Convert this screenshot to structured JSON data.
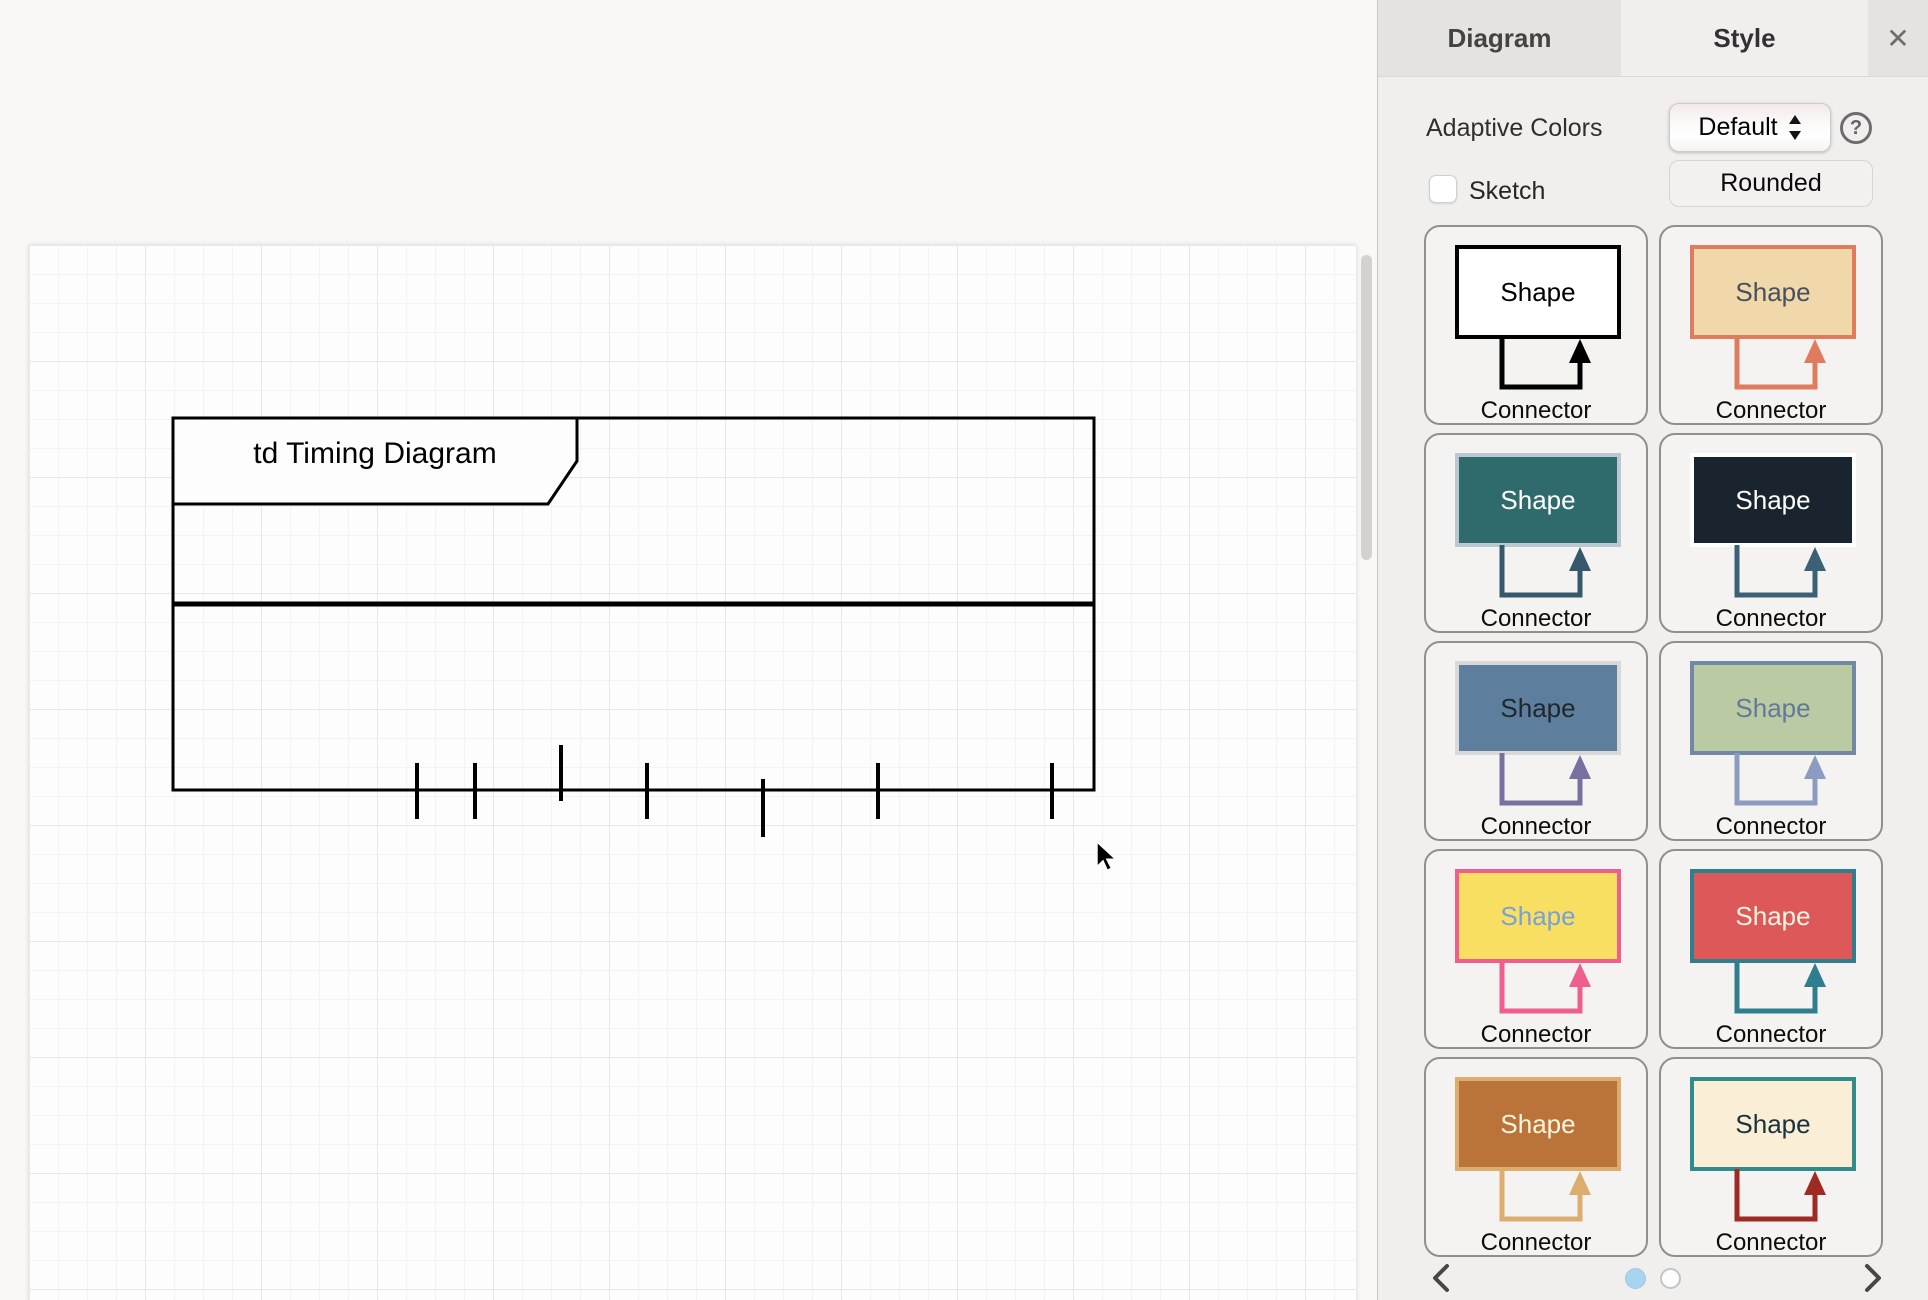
{
  "canvas": {
    "diagram": {
      "frame_title": "td Timing Diagram",
      "frame": {
        "x": 173,
        "y": 418,
        "width": 921,
        "height": 372,
        "stroke": "#000000",
        "stroke_width": 3
      },
      "title_box": {
        "points": "173,418 577,418 577,461 548,504 173,504",
        "fill": "#fdfdfd"
      },
      "title_pos": {
        "x": 375,
        "y": 463
      },
      "divider": {
        "y": 604,
        "stroke_width": 5
      },
      "ticks": [
        {
          "x": 417,
          "y1": 763,
          "y2": 819
        },
        {
          "x": 475,
          "y1": 763,
          "y2": 819
        },
        {
          "x": 561,
          "y1": 745,
          "y2": 801
        },
        {
          "x": 647,
          "y1": 763,
          "y2": 819
        },
        {
          "x": 763,
          "y1": 779,
          "y2": 837
        },
        {
          "x": 878,
          "y1": 763,
          "y2": 819
        },
        {
          "x": 1052,
          "y1": 763,
          "y2": 819
        }
      ]
    }
  },
  "panel": {
    "tabs": [
      {
        "id": "diagram",
        "label": "Diagram",
        "active": false
      },
      {
        "id": "style",
        "label": "Style",
        "active": true
      }
    ],
    "close_icon": "✕",
    "adaptive_colors": {
      "label": "Adaptive Colors",
      "value": "Default",
      "help_icon": "?"
    },
    "sketch": {
      "label": "Sketch",
      "checked": false
    },
    "rounded_label": "Rounded",
    "style_presets": [
      {
        "shape_label": "Shape",
        "connector_label": "Connector",
        "fill": "#ffffff",
        "stroke": "#000000",
        "text": "#000000",
        "connector": "#000000"
      },
      {
        "shape_label": "Shape",
        "connector_label": "Connector",
        "fill": "#f0d8aa",
        "stroke": "#e07c5e",
        "text": "#46505f",
        "connector": "#e07c5e"
      },
      {
        "shape_label": "Shape",
        "connector_label": "Connector",
        "fill": "#2f6a6d",
        "stroke": "#bac9d1",
        "text": "#ffffff",
        "connector": "#36586d"
      },
      {
        "shape_label": "Shape",
        "connector_label": "Connector",
        "fill": "#19242f",
        "stroke": "#ffffff",
        "text": "#ffffff",
        "connector": "#3c6076"
      },
      {
        "shape_label": "Shape",
        "connector_label": "Connector",
        "fill": "#5d7f9d",
        "stroke": "#d9d9d9",
        "text": "#20272e",
        "connector": "#78719f"
      },
      {
        "shape_label": "Shape",
        "connector_label": "Connector",
        "fill": "#bacba4",
        "stroke": "#7289a6",
        "text": "#64789a",
        "connector": "#8c9cc1"
      },
      {
        "shape_label": "Shape",
        "connector_label": "Connector",
        "fill": "#f8df62",
        "stroke": "#ee5f90",
        "text": "#76a2d9",
        "connector": "#ee5f90"
      },
      {
        "shape_label": "Shape",
        "connector_label": "Connector",
        "fill": "#dd5858",
        "stroke": "#307d8e",
        "text": "#fdf5e2",
        "connector": "#307d8e"
      },
      {
        "shape_label": "Shape",
        "connector_label": "Connector",
        "fill": "#ba7439",
        "stroke": "#dcad6e",
        "text": "#fbf4df",
        "connector": "#dcad6e"
      },
      {
        "shape_label": "Shape",
        "connector_label": "Connector",
        "fill": "#faeed6",
        "stroke": "#2f8c8b",
        "text": "#173240",
        "connector": "#9e2a23"
      }
    ],
    "pagination": {
      "dots": [
        {
          "active": true
        },
        {
          "active": false
        }
      ]
    }
  }
}
